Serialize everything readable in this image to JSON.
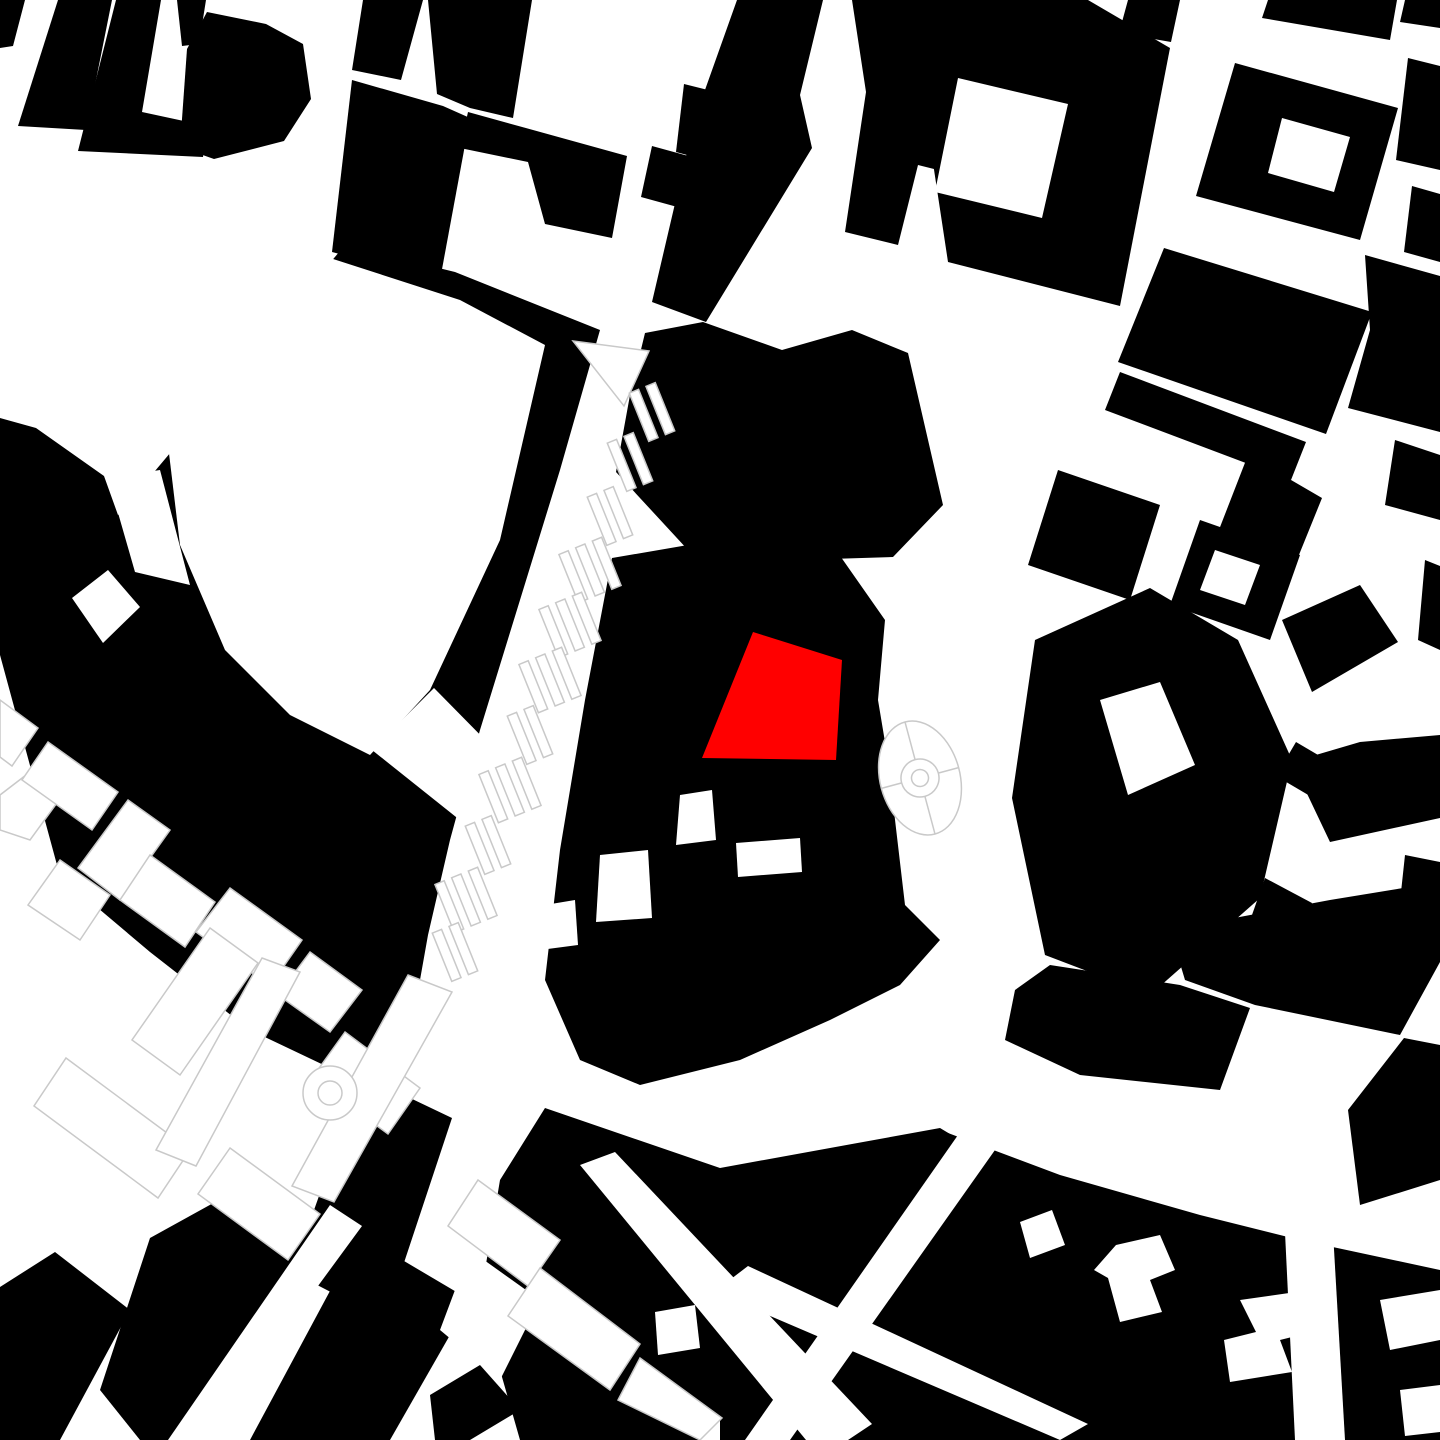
{
  "map": {
    "kind": "figure-ground-site-plan",
    "canvas": {
      "width": 1440,
      "height": 1440
    },
    "colors": {
      "background": "#ffffff",
      "building": "#000000",
      "site_highlight": "#ff0000",
      "parcel_outline": "#c9c9c9",
      "courtyard": "#ffffff"
    },
    "site": {
      "points": "753,632 842,660 836,760 702,758"
    },
    "buildings": [
      {
        "points": "0,0 25,0 13,46 0,48"
      },
      {
        "points": "58,0 112,0 86,130 18,126"
      },
      {
        "points": "116,0 161,0 142,112 207,126 203,157 78,151"
      },
      {
        "points": "177,0 206,0 199,44 182,46"
      },
      {
        "points": "207,12 266,24 303,44 311,99 284,141 214,159 180,147 187,49"
      },
      {
        "points": "363,0 423,0 401,80 352,70"
      },
      {
        "points": "352,80 443,106 470,118 440,280 332,252"
      },
      {
        "points": "428,0 532,0 513,118 470,108 437,94"
      },
      {
        "points": "468,112 627,156 612,238 545,224 528,162 460,148"
      },
      {
        "points": "652,146 692,157 681,208 641,197"
      },
      {
        "points": "684,84 728,95 717,163 676,152"
      },
      {
        "points": "737,0 823,0 800,95 812,148 706,322 652,302 695,118"
      },
      {
        "points": "852,0 948,0 939,88 1000,106 986,182 918,165 898,245 845,232 866,92"
      },
      {
        "points": "912,0 1088,0 1170,48 1120,306 948,262 928,130"
      },
      {
        "points": "1235,63 1398,108 1360,240 1196,196"
      },
      {
        "points": "1128,0 1180,0 1171,42 1119,33"
      },
      {
        "points": "1268,0 1397,0 1390,40 1262,18"
      },
      {
        "points": "1405,0 1440,0 1440,28 1400,22"
      },
      {
        "points": "1408,58 1440,66 1440,170 1396,160"
      },
      {
        "points": "1412,186 1440,194 1440,262 1404,252"
      },
      {
        "points": "1365,255 1440,276 1440,432 1348,408 1370,330"
      },
      {
        "points": "1118,52 1165,62 1155,108 1108,96"
      },
      {
        "points": "1164,248 1372,312 1326,434 1118,362"
      },
      {
        "points": "1120,372 1306,442 1291,480 1105,410"
      },
      {
        "points": "1058,470 1160,505 1130,600 1028,565"
      },
      {
        "points": "1200,520 1300,555 1270,640 1170,605"
      },
      {
        "points": "1395,440 1440,455 1440,520 1385,505"
      },
      {
        "points": "1248,455 1322,498 1288,582 1215,540"
      },
      {
        "points": "1282,620 1360,585 1398,642 1312,692"
      },
      {
        "points": "1212,700 1272,736 1230,800 1178,764"
      },
      {
        "points": "1296,742 1330,762 1310,796 1276,776"
      },
      {
        "points": "1265,878 1312,903 1288,956 1246,932"
      },
      {
        "points": "1425,560 1440,566 1440,650 1418,640"
      },
      {
        "points": "1405,855 1440,862 1440,930 1398,920"
      },
      {
        "points": "645,333 703,322 782,350 852,330 908,353 943,505 893,557 700,563 616,472 630,395"
      },
      {
        "points": "612,558 688,545 836,550 885,620 878,700 888,760 905,905 940,940 900,985 830,1020 740,1060 640,1085 580,1060 545,980 560,850 585,700"
      },
      {
        "points": "0,418 36,428 104,476 118,515 345,245 455,272 600,330 560,470 520,600 480,730 450,840 428,935 415,1008 378,1042 330,1068 250,1030 150,952 60,876 0,655"
      },
      {
        "points": "168,480 230,455 250,478 310,470 330,520 300,560 310,610 260,648 210,640 195,600 160,560 178,520"
      },
      {
        "points": "362,1075 452,1118 385,1320 292,1272"
      },
      {
        "points": "1035,640 1150,588 1238,640 1292,760 1260,898 1150,995 1045,955 1012,798"
      },
      {
        "points": "1292,762 1360,742 1440,735 1440,818 1330,842"
      },
      {
        "points": "1170,930 1330,900 1440,882 1440,962 1400,1035 1255,1005 1185,980"
      },
      {
        "points": "1050,965 1180,985 1250,1008 1220,1090 1080,1075 1005,1040 1015,990"
      },
      {
        "points": "1404,1038 1440,1045 1440,1180 1360,1205 1348,1110"
      },
      {
        "points": "720,1175 940,1130 1060,1175 1200,1215 1300,1240 1440,1270 1440,1440 720,1440"
      },
      {
        "points": "545,1108 720,1168 940,1128 960,1140 700,1440 520,1440 480,1300 500,1180"
      },
      {
        "points": "0,1287 55,1252 130,1310 60,1440 0,1440"
      },
      {
        "points": "150,1238 255,1180 330,1240 195,1440 140,1440 100,1390"
      },
      {
        "points": "360,1235 470,1300 390,1440 250,1440"
      },
      {
        "points": "430,1395 480,1365 520,1410 470,1440 435,1440"
      },
      {
        "points": "855,1235 898,1222 940,1260 900,1295 858,1280"
      }
    ],
    "courtyards": [
      {
        "points": "958,78 1068,104 1042,218 935,192"
      },
      {
        "points": "1282,118 1350,137 1334,192 1268,173"
      },
      {
        "points": "1215,550 1260,565 1245,605 1200,590"
      },
      {
        "points": "680,795 712,790 716,840 676,845"
      },
      {
        "points": "736,843 800,838 802,872 738,877"
      },
      {
        "points": "600,855 648,850 652,918 596,922"
      },
      {
        "points": "545,905 575,900 578,945 540,950"
      },
      {
        "points": "196,290 330,258 460,300 545,345 500,540 430,690 370,755 290,715 225,650 180,545 165,420"
      },
      {
        "points": "372,750 434,688 562,818 520,868"
      },
      {
        "points": "72,598 108,570 140,607 103,643"
      },
      {
        "points": "1100,700 1160,682 1195,765 1128,795"
      },
      {
        "points": "108,478 160,470 190,585 135,572"
      },
      {
        "points": "655,1312 695,1305 700,1348 658,1355"
      },
      {
        "points": "958,1135 995,1150 790,1440 745,1440"
      },
      {
        "points": "714,1292 748,1266 1088,1424 1060,1440"
      },
      {
        "points": "1282,1170 1330,1180 1345,1440 1295,1440"
      },
      {
        "points": "1116,1245 1160,1235 1175,1270 1150,1280 1162,1312 1120,1322 1108,1278 1094,1270"
      },
      {
        "points": "1240,1300 1310,1290 1320,1330 1280,1340 1292,1372 1230,1382 1224,1340 1256,1332"
      },
      {
        "points": "1380,1300 1440,1290 1440,1340 1390,1350"
      },
      {
        "points": "1400,1390 1440,1385 1440,1432 1405,1436"
      },
      {
        "points": "580,1165 615,1152 872,1424 848,1440 806,1440"
      },
      {
        "points": "330,1205 362,1226 205,1440 168,1440"
      },
      {
        "points": "1020,1222 1052,1210 1065,1245 1030,1258"
      },
      {
        "points": "470,1250 540,1300 500,1380 440,1330"
      }
    ],
    "outlined_parcels": [
      {
        "points": "0,700 38,728 12,766 0,757"
      },
      {
        "points": "0,795 30,772 62,796 30,840 0,830"
      },
      {
        "points": "48,742 118,792 92,830 22,780"
      },
      {
        "points": "128,800 170,830 120,900 78,868"
      },
      {
        "points": "60,860 110,895 80,940 28,905"
      },
      {
        "points": "150,855 215,902 185,947 120,900"
      },
      {
        "points": "230,888 302,940 270,986 196,932"
      },
      {
        "points": "210,928 258,963 180,1075 132,1040"
      },
      {
        "points": "310,952 362,990 330,1032 278,995"
      },
      {
        "points": "345,1032 420,1088 388,1134 312,1078"
      },
      {
        "points": "66,1058 190,1150 158,1198 34,1106"
      },
      {
        "points": "230,1148 320,1214 288,1260 198,1194"
      },
      {
        "points": "262,958 300,972 196,1166 156,1150"
      },
      {
        "points": "408,975 452,992 334,1202 292,1186"
      },
      {
        "points": "478,1180 560,1240 528,1286 448,1226"
      },
      {
        "points": "540,1268 640,1344 610,1390 508,1316"
      },
      {
        "points": "640,1358 722,1418 700,1440 618,1400"
      },
      {
        "points": "573,341 649,351 624,406"
      }
    ],
    "tram_platforms": {
      "angle_deg": -22,
      "length": 52,
      "width": 10,
      "lane_spacing": 18,
      "groups": [
        {
          "cx": 652,
          "cy": 412,
          "n": 2
        },
        {
          "cx": 630,
          "cy": 462,
          "n": 2
        },
        {
          "cx": 610,
          "cy": 516,
          "n": 2
        },
        {
          "cx": 590,
          "cy": 570,
          "n": 3
        },
        {
          "cx": 570,
          "cy": 625,
          "n": 3
        },
        {
          "cx": 550,
          "cy": 680,
          "n": 3
        },
        {
          "cx": 530,
          "cy": 735,
          "n": 2
        },
        {
          "cx": 510,
          "cy": 790,
          "n": 3
        },
        {
          "cx": 488,
          "cy": 845,
          "n": 2
        },
        {
          "cx": 466,
          "cy": 900,
          "n": 3
        },
        {
          "cx": 455,
          "cy": 952,
          "n": 2
        }
      ]
    },
    "fountain": {
      "cx": 920,
      "cy": 778,
      "rx": 40,
      "ry": 58,
      "rotate_deg": -15,
      "basin_r": 19,
      "hub_r": 8.5
    },
    "roundabout_circle": {
      "cx": 330,
      "cy": 1093,
      "r_outer": 27,
      "r_inner": 12
    }
  }
}
